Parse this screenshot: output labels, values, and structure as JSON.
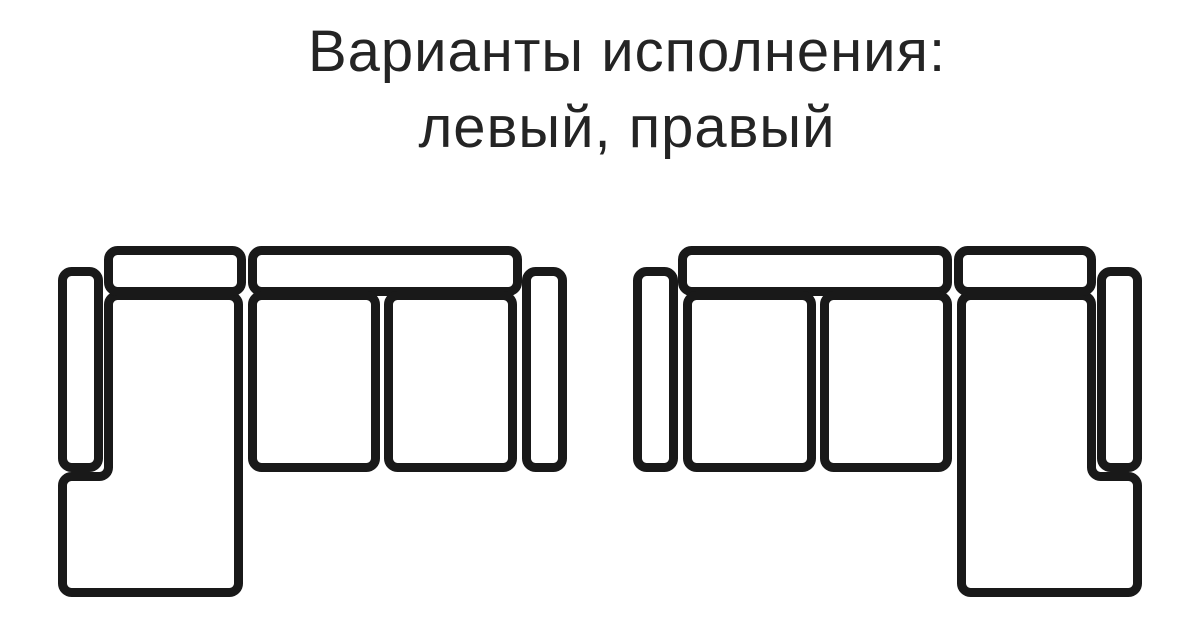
{
  "title": {
    "line1": "Варианты исполнения:",
    "line2": "левый, правый"
  },
  "diagram": {
    "variants": [
      {
        "name": "левый",
        "chaise_side": "left"
      },
      {
        "name": "правый",
        "chaise_side": "right"
      }
    ],
    "colors": {
      "outline": "#191919",
      "fill": "#ffffff",
      "background": "#ffffff",
      "text": "#242424"
    }
  }
}
